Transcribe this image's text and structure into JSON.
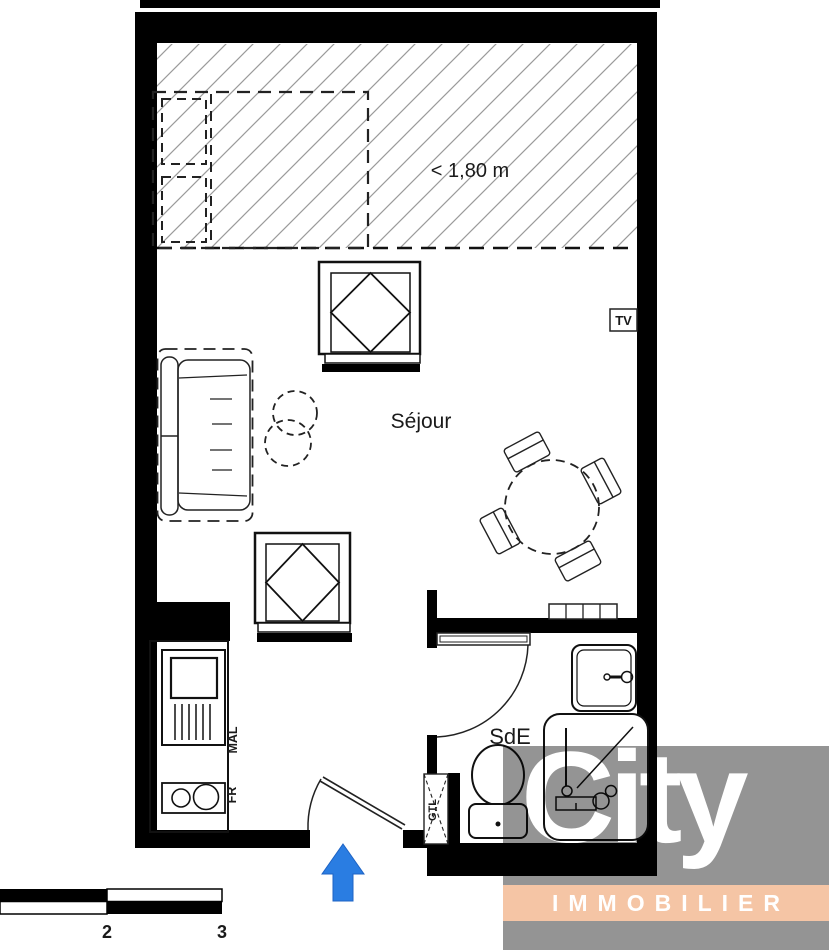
{
  "plan": {
    "labels": {
      "room": "Séjour",
      "bathroom": "SdE",
      "height_limit": "< 1,80 m",
      "tv": "TV",
      "washer": "MAL",
      "fridge": "FR",
      "duct": "GTL"
    },
    "scale_bar": {
      "tick_2": "2",
      "tick_3": "3"
    },
    "entrance_arrow_color": "#2a7de2",
    "wall_color": "#000000",
    "hatch_line_color": "#9a9a9a"
  },
  "logo": {
    "brand": "City",
    "tagline": "IMMOBILIER",
    "panel_color": "#949494",
    "band_color": "#f5c5a5",
    "text_color": "#ffffff"
  }
}
